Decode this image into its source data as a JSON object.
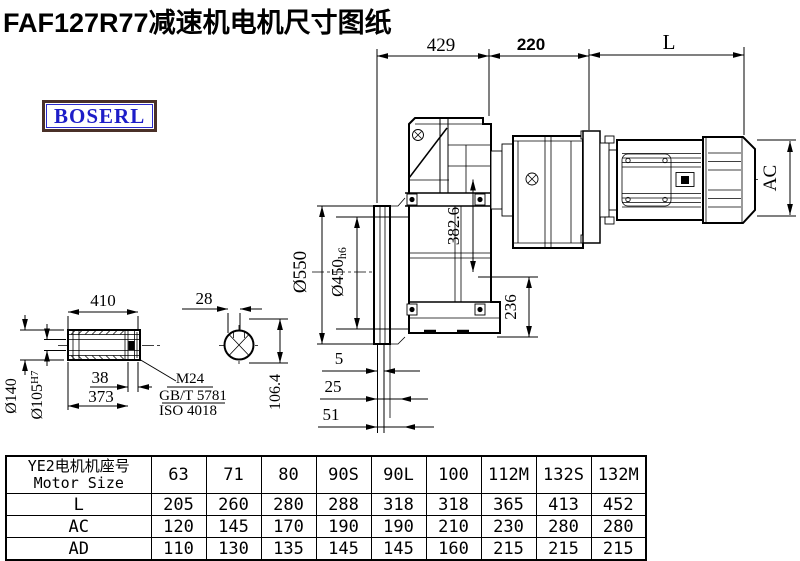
{
  "page": {
    "title": "FAF127R77减速机电机尺寸图纸",
    "brand": "BOSERL"
  },
  "dims": {
    "top429": "429",
    "top220": "220",
    "topL": "L",
    "dia550": "Ø550",
    "dia450": "Ø450",
    "dia450_tol": "h6",
    "axis382": "382.6",
    "foot236": "236",
    "motorAC": "AC",
    "gap5": "5",
    "gap25": "25",
    "gap51": "51",
    "shaft410": "410",
    "shaft38": "38",
    "shaft373": "373",
    "dia140": "Ø140",
    "dia105": "Ø105",
    "dia105_tol": "H7",
    "key28": "28",
    "key106": "106.4",
    "noteM24": "M24",
    "noteGB": "GB/T 5781",
    "noteISO": "ISO 4018"
  },
  "table": {
    "header_cn": "YE2电机机座号",
    "header_en": "Motor Size",
    "columns": [
      "63",
      "71",
      "80",
      "90S",
      "90L",
      "100",
      "112M",
      "132S",
      "132M"
    ],
    "rows": [
      {
        "label": "L",
        "values": [
          "205",
          "260",
          "280",
          "288",
          "318",
          "318",
          "365",
          "413",
          "452"
        ]
      },
      {
        "label": "AC",
        "values": [
          "120",
          "145",
          "170",
          "190",
          "190",
          "210",
          "230",
          "280",
          "280"
        ]
      },
      {
        "label": "AD",
        "values": [
          "110",
          "130",
          "135",
          "145",
          "145",
          "160",
          "215",
          "215",
          "215"
        ]
      }
    ]
  }
}
